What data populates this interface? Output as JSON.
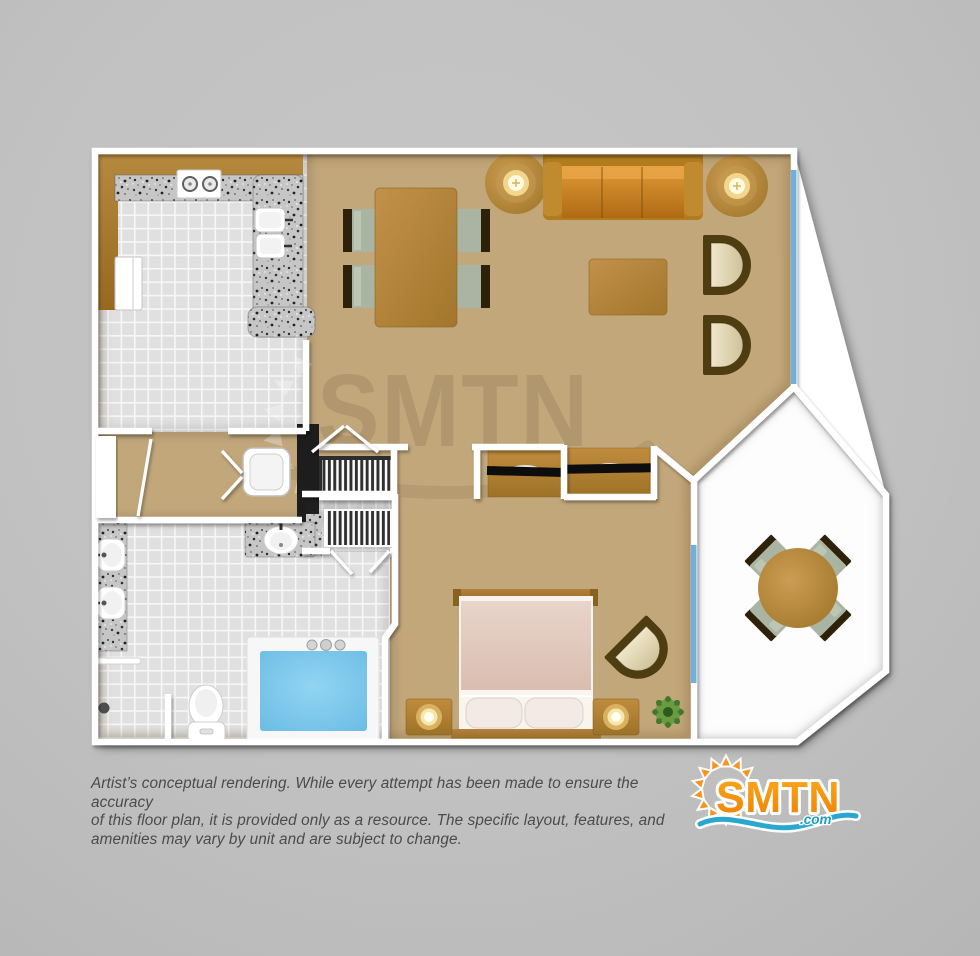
{
  "page": {
    "background": "#c1c1c1"
  },
  "watermark": {
    "text": "SMTN"
  },
  "disclaimer": {
    "line1": "Artist’s conceptual rendering. While every attempt has been made to ensure the accuracy",
    "line2": "of this floor plan, it is provided only as a resource. The specific layout, features, and",
    "line3": "amenities may vary by unit and are subject to change."
  },
  "logo": {
    "brand": "SMTN",
    "tld": ".com"
  },
  "colors": {
    "carpet": "#c2a77b",
    "tile": "#e1e1e2",
    "granite": "#c4c4c4",
    "cabinet_wood": "#a87c30",
    "sofa_orange": "#c97e22",
    "chair_seat_sage": "#a9b5a2",
    "chair_back_brown": "#2e2109",
    "tub_water_blue": "#74c6ea",
    "window_blue": "#6fb0dd",
    "wall_white": "#ffffff",
    "logo_orange": "#f68b1f",
    "logo_blue": "#29a7d1"
  }
}
